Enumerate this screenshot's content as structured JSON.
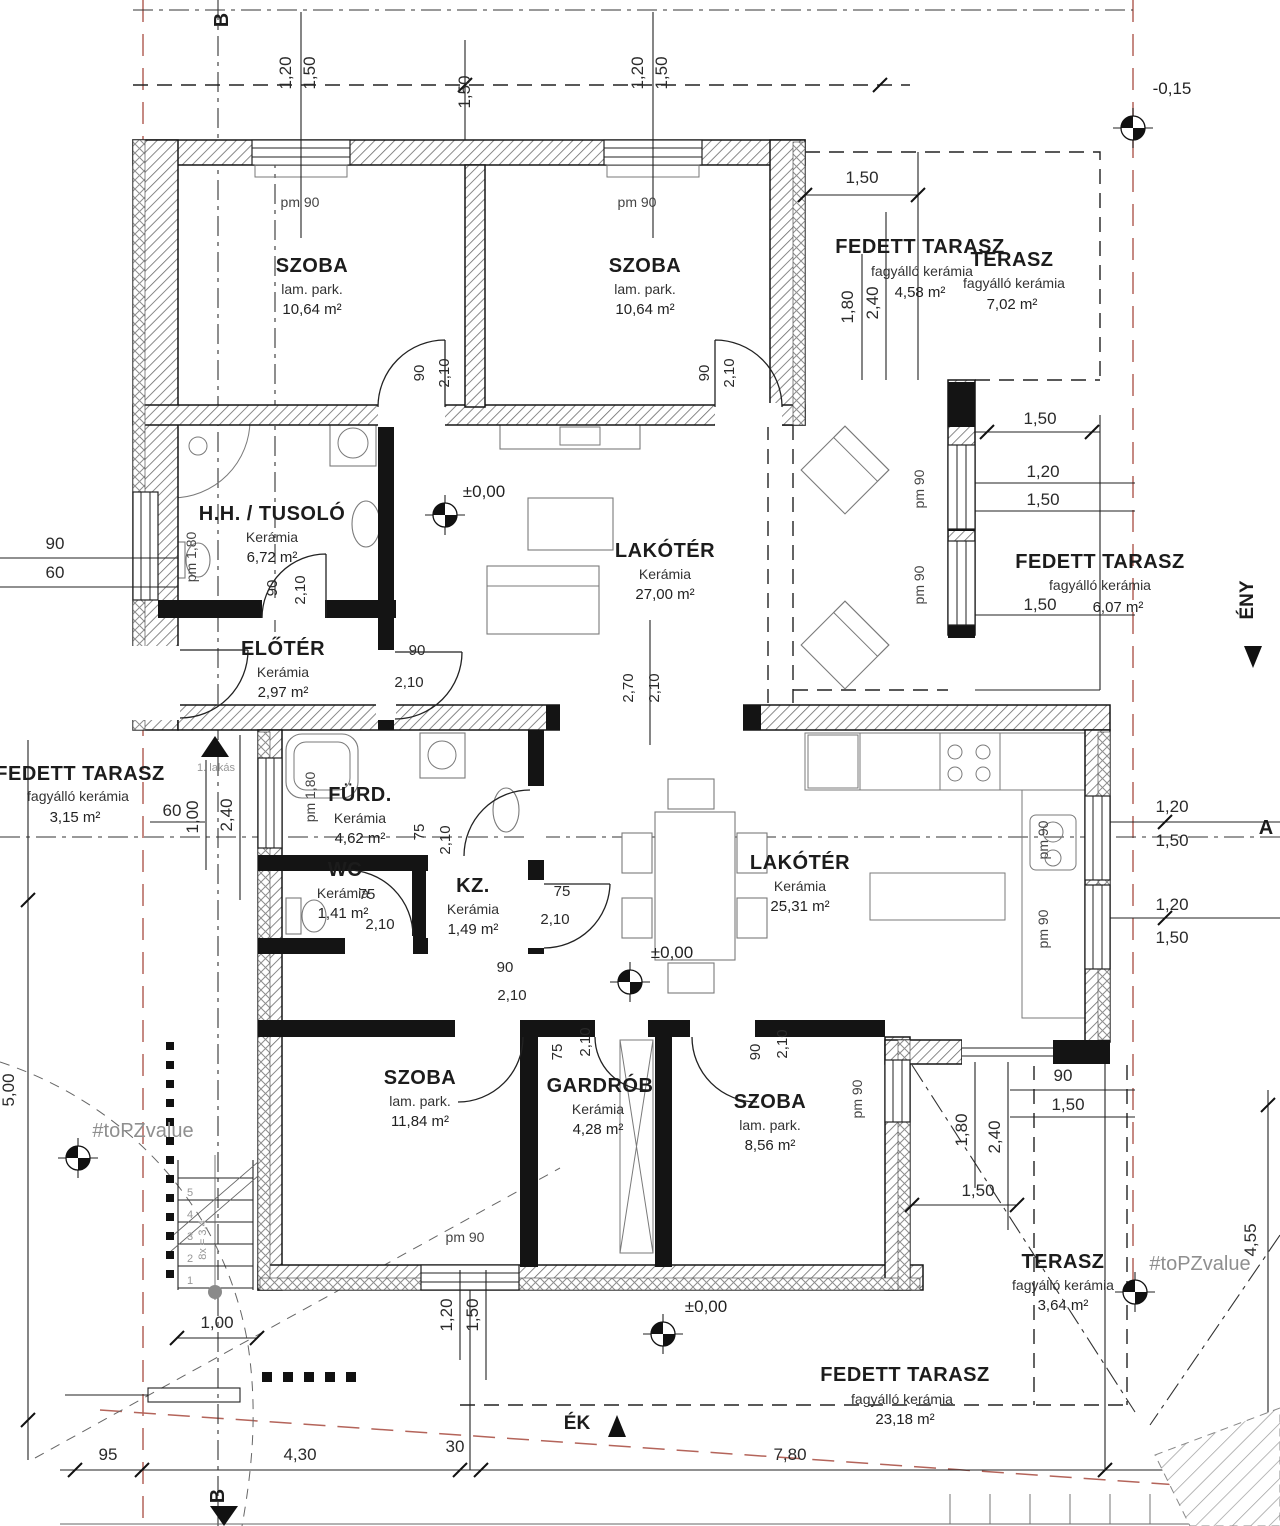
{
  "rooms": [
    {
      "name": "SZOBA",
      "material": "lam. park.",
      "area": "10,64 m²"
    },
    {
      "name": "SZOBA",
      "material": "lam. park.",
      "area": "10,64 m²"
    },
    {
      "name": "FEDETT TARASZ",
      "material": "fagyálló kerámia",
      "area": "4,58 m²"
    },
    {
      "name": "TERASZ",
      "material": "fagyálló kerámia",
      "area": "7,02 m²"
    },
    {
      "name": "H.H. / TUSOLÓ",
      "material": "Kerámia",
      "area": "6,72 m²"
    },
    {
      "name": "LAKÓTÉR",
      "material": "Kerámia",
      "area": "27,00 m²"
    },
    {
      "name": "ELŐTÉR",
      "material": "Kerámia",
      "area": "2,97 m²"
    },
    {
      "name": "FEDETT TARASZ",
      "material": "fagyálló kerámia",
      "area": "3,15 m²"
    },
    {
      "name": "FEDETT TARASZ",
      "material": "fagyálló kerámia",
      "area": "6,07 m²"
    },
    {
      "name": "FÜRD.",
      "material": "Kerámia",
      "area": "4,62 m²"
    },
    {
      "name": "WC",
      "material": "Kerámia",
      "area": "1,41 m²"
    },
    {
      "name": "KZ.",
      "material": "Kerámia",
      "area": "1,49 m²"
    },
    {
      "name": "LAKÓTÉR",
      "material": "Kerámia",
      "area": "25,31 m²"
    },
    {
      "name": "SZOBA",
      "material": "lam. park.",
      "area": "11,84 m²"
    },
    {
      "name": "GARDRÓB",
      "material": "Kerámia",
      "area": "4,28 m²"
    },
    {
      "name": "SZOBA",
      "material": "lam. park.",
      "area": "8,56 m²"
    },
    {
      "name": "TERASZ",
      "material": "fagyálló kerámia",
      "area": "3,64 m²"
    },
    {
      "name": "FEDETT TARASZ",
      "material": "fagyálló kerámia",
      "area": "23,18 m²"
    }
  ],
  "levels": {
    "minus": "-0,15",
    "zero1": "±0,00",
    "zero2": "±0,00",
    "zero3": "±0,00"
  },
  "sections": {
    "a": "A",
    "b_top": "B",
    "b_bottom": "B"
  },
  "compass": {
    "eny": "ÉNY",
    "ek": "ÉK"
  },
  "entrance": {
    "label": "1. lakás"
  },
  "watermark": {
    "left": "#toPZvalue",
    "right": "#toPZvalue"
  },
  "stairs": {
    "steps": [
      "1",
      "2",
      "3",
      "4",
      "5"
    ],
    "note": "8x = 3,4",
    "width": "1,00"
  },
  "dims": {
    "top": [
      "1,20",
      "1,50",
      "1,50",
      "1,20",
      "1,50"
    ],
    "top_right": [
      "1,50",
      "1,80",
      "2,40"
    ],
    "right_upper": [
      "1,50",
      "1,20",
      "1,50",
      "1,50"
    ],
    "right_mid": [
      "1,20",
      "1,50",
      "1,20",
      "1,50"
    ],
    "right_lower": [
      "90",
      "1,50",
      "1,80",
      "2,40",
      "1,50",
      "4,55"
    ],
    "left": [
      "90",
      "60",
      "5,00"
    ],
    "entry": [
      "60",
      "1,00",
      "2,40"
    ],
    "bottom": [
      "95",
      "4,30",
      "30",
      "7,80"
    ],
    "bottom_mid": [
      "1,20",
      "1,50"
    ]
  },
  "door_dims": [
    {
      "w": "90",
      "h": "2,10"
    },
    {
      "w": "90",
      "h": "2,10"
    },
    {
      "w": "90",
      "h": "2,10"
    },
    {
      "w": "90",
      "h": "2,10"
    },
    {
      "w": "2,70",
      "h": "2,10"
    },
    {
      "w": "75",
      "h": "2,10"
    },
    {
      "w": "75",
      "h": "2,10"
    },
    {
      "w": "75",
      "h": "2,10"
    },
    {
      "w": "90",
      "h": "2,10"
    },
    {
      "w": "75",
      "h": "2,10"
    },
    {
      "w": "90",
      "h": "2,10"
    }
  ],
  "window_labels": [
    "pm 90",
    "pm 90",
    "pm 1,80",
    "pm 1,80",
    "pm 90",
    "pm 90",
    "pm 90",
    "pm 90",
    "pm 90",
    "pm 90"
  ]
}
